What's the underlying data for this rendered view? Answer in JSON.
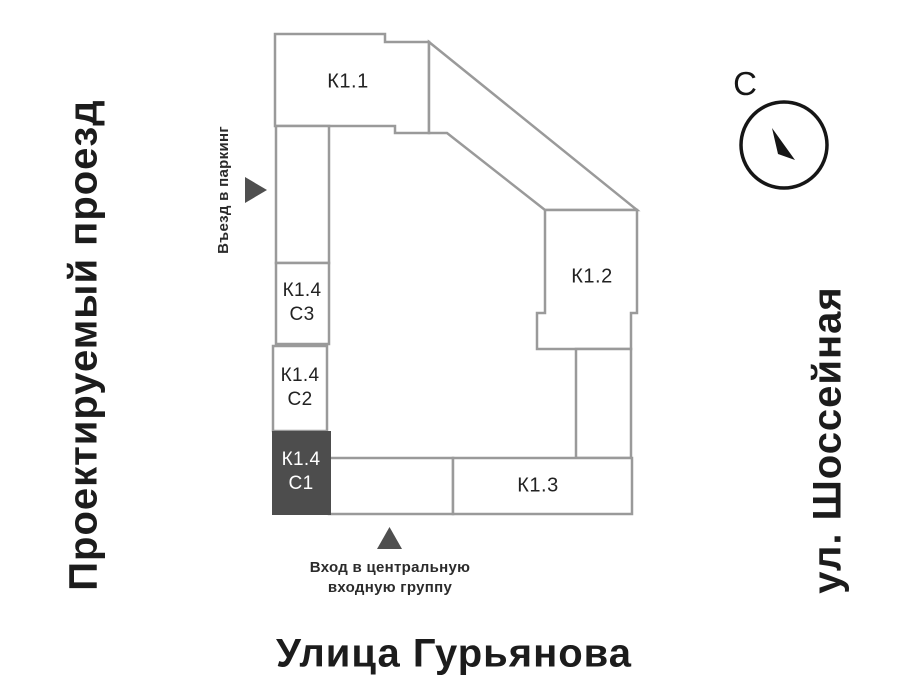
{
  "streets": {
    "left": "Проектируемый проезд",
    "right": "ул. Шоссейная",
    "bottom": "Улица Гурьянова"
  },
  "buildings": {
    "k1_1": {
      "label": "К1.1"
    },
    "k1_2": {
      "label": "К1.2"
    },
    "k1_3": {
      "label": "К1.3"
    },
    "k1_4_c3": {
      "line1": "К1.4",
      "line2": "С3"
    },
    "k1_4_c2": {
      "line1": "К1.4",
      "line2": "С2"
    },
    "k1_4_c1": {
      "line1": "К1.4",
      "line2": "С1"
    }
  },
  "markers": {
    "parking_label": "Въезд в паркинг",
    "entrance_line1": "Вход в центральную",
    "entrance_line2": "входную группу"
  },
  "compass": {
    "north_label": "С"
  },
  "colors": {
    "outline": "#9a9a9a",
    "building_fill": "#ffffff",
    "selected_fill": "#4d4d4d",
    "marker": "#4f4f4f",
    "text": "#1d1d1d",
    "compass": "#161616"
  }
}
